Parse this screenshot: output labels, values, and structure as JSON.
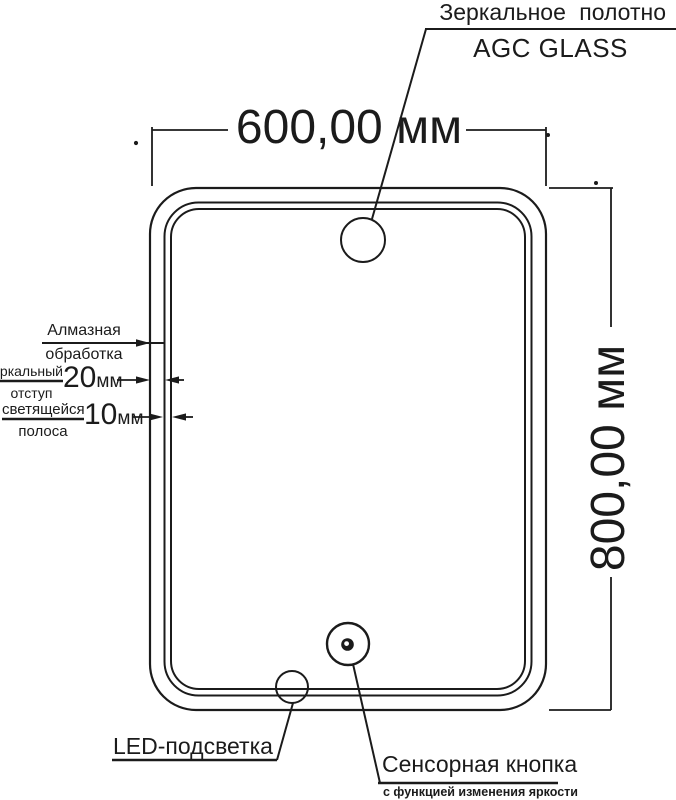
{
  "colors": {
    "ink": "#1b1b1b",
    "background": "#ffffff"
  },
  "annotations": {
    "mirror_panel": {
      "label": "Зеркальное полотно",
      "material": "AGC GLASS"
    },
    "width": "600,00 мм",
    "height": "800,00 мм",
    "diamond_edge": {
      "line1": "Алмазная",
      "line2": "обработка"
    },
    "mirror_offset": {
      "line1": "Зеркальный",
      "line2": "отступ",
      "value": "20",
      "unit": "мм"
    },
    "light_strip": {
      "line1": "светящейся",
      "line2": "полоса",
      "value": "10",
      "unit": "мм"
    },
    "led": "LED-подсветка",
    "touch_button": {
      "label": "Сенсорная кнопка",
      "note": "с функцией изменения яркости"
    }
  }
}
